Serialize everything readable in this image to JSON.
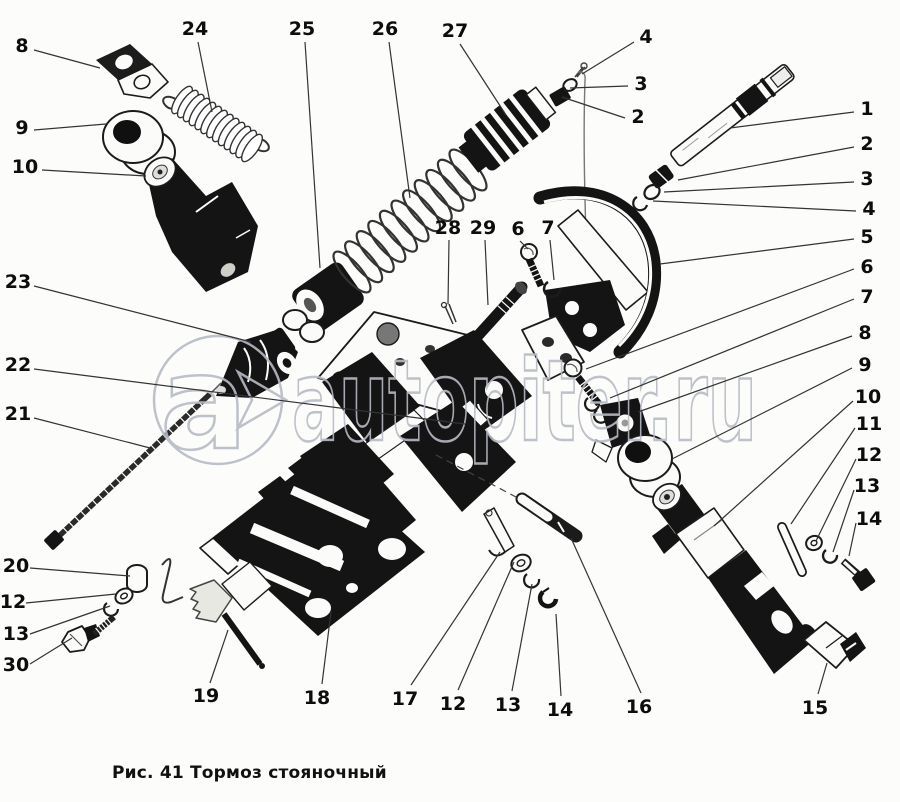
{
  "figure": {
    "caption": "Рис. 41 Тормоз стояночный",
    "watermark": {
      "logo": "a",
      "text": "autopiter.ru"
    },
    "callouts": [
      {
        "n": "8",
        "tx": 22,
        "ty": 52,
        "lx": 34,
        "ly": 50,
        "px": 100,
        "py": 68
      },
      {
        "n": "9",
        "tx": 22,
        "ty": 134,
        "lx": 34,
        "ly": 130,
        "px": 106,
        "py": 124
      },
      {
        "n": "10",
        "tx": 25,
        "ty": 173,
        "lx": 42,
        "ly": 170,
        "px": 146,
        "py": 176
      },
      {
        "n": "23",
        "tx": 18,
        "ty": 288,
        "lx": 34,
        "ly": 286,
        "px": 251,
        "py": 342
      },
      {
        "n": "22",
        "tx": 18,
        "ty": 371,
        "lx": 34,
        "ly": 369,
        "px": 465,
        "py": 424
      },
      {
        "n": "21",
        "tx": 18,
        "ty": 420,
        "lx": 34,
        "ly": 418,
        "px": 150,
        "py": 448
      },
      {
        "n": "20",
        "tx": 16,
        "ty": 572,
        "lx": 30,
        "ly": 568,
        "px": 130,
        "py": 576
      },
      {
        "n": "12",
        "tx": 13,
        "ty": 608,
        "lx": 26,
        "ly": 603,
        "px": 116,
        "py": 594
      },
      {
        "n": "13",
        "tx": 16,
        "ty": 640,
        "lx": 30,
        "ly": 634,
        "px": 110,
        "py": 606
      },
      {
        "n": "30",
        "tx": 16,
        "ty": 671,
        "lx": 30,
        "ly": 664,
        "px": 72,
        "py": 638
      },
      {
        "n": "24",
        "tx": 195,
        "ty": 35,
        "lx": 198,
        "ly": 42,
        "px": 212,
        "py": 112
      },
      {
        "n": "25",
        "tx": 302,
        "ty": 35,
        "lx": 305,
        "ly": 42,
        "px": 320,
        "py": 268
      },
      {
        "n": "26",
        "tx": 385,
        "ty": 35,
        "lx": 389,
        "ly": 42,
        "px": 410,
        "py": 198
      },
      {
        "n": "27",
        "tx": 455,
        "ty": 37,
        "lx": 460,
        "ly": 44,
        "px": 506,
        "py": 115
      },
      {
        "n": "4",
        "tx": 646,
        "ty": 43,
        "lx": 634,
        "ly": 42,
        "px": 582,
        "py": 74
      },
      {
        "n": "3",
        "tx": 641,
        "ty": 90,
        "lx": 628,
        "ly": 86,
        "px": 570,
        "py": 88
      },
      {
        "n": "2",
        "tx": 638,
        "ty": 123,
        "lx": 625,
        "ly": 118,
        "px": 562,
        "py": 97
      },
      {
        "n": "28",
        "tx": 448,
        "ty": 234,
        "lx": 449,
        "ly": 240,
        "px": 448,
        "py": 304
      },
      {
        "n": "29",
        "tx": 483,
        "ty": 234,
        "lx": 485,
        "ly": 240,
        "px": 488,
        "py": 305
      },
      {
        "n": "6",
        "tx": 518,
        "ty": 235,
        "lx": 520,
        "ly": 241,
        "px": 528,
        "py": 249
      },
      {
        "n": "7",
        "tx": 548,
        "ty": 234,
        "lx": 550,
        "ly": 240,
        "px": 554,
        "py": 280
      },
      {
        "n": "1",
        "tx": 867,
        "ty": 115,
        "lx": 854,
        "ly": 112,
        "px": 730,
        "py": 128
      },
      {
        "n": "2",
        "tx": 867,
        "ty": 150,
        "lx": 854,
        "ly": 147,
        "px": 678,
        "py": 180
      },
      {
        "n": "3",
        "tx": 867,
        "ty": 185,
        "lx": 854,
        "ly": 182,
        "px": 664,
        "py": 192
      },
      {
        "n": "4",
        "tx": 869,
        "ty": 215,
        "lx": 856,
        "ly": 211,
        "px": 653,
        "py": 201
      },
      {
        "n": "5",
        "tx": 867,
        "ty": 243,
        "lx": 854,
        "ly": 239,
        "px": 660,
        "py": 264
      },
      {
        "n": "6",
        "tx": 867,
        "ty": 273,
        "lx": 854,
        "ly": 269,
        "px": 586,
        "py": 369
      },
      {
        "n": "7",
        "tx": 867,
        "ty": 303,
        "lx": 854,
        "ly": 299,
        "px": 610,
        "py": 398
      },
      {
        "n": "8",
        "tx": 865,
        "ty": 339,
        "lx": 852,
        "ly": 336,
        "px": 638,
        "py": 412
      },
      {
        "n": "9",
        "tx": 865,
        "ty": 371,
        "lx": 852,
        "ly": 368,
        "px": 672,
        "py": 459
      },
      {
        "n": "10",
        "tx": 868,
        "ty": 403,
        "lx": 853,
        "ly": 401,
        "px": 714,
        "py": 526
      },
      {
        "n": "11",
        "tx": 869,
        "ty": 430,
        "lx": 855,
        "ly": 428,
        "px": 791,
        "py": 524
      },
      {
        "n": "12",
        "tx": 869,
        "ty": 461,
        "lx": 856,
        "ly": 459,
        "px": 816,
        "py": 541
      },
      {
        "n": "13",
        "tx": 867,
        "ty": 492,
        "lx": 854,
        "ly": 490,
        "px": 833,
        "py": 552
      },
      {
        "n": "14",
        "tx": 869,
        "ty": 525,
        "lx": 856,
        "ly": 523,
        "px": 849,
        "py": 556
      },
      {
        "n": "19",
        "tx": 206,
        "ty": 702,
        "lx": 210,
        "ly": 683,
        "px": 228,
        "py": 630
      },
      {
        "n": "18",
        "tx": 317,
        "ty": 704,
        "lx": 322,
        "ly": 684,
        "px": 331,
        "py": 612
      },
      {
        "n": "17",
        "tx": 405,
        "ty": 705,
        "lx": 411,
        "ly": 685,
        "px": 500,
        "py": 552
      },
      {
        "n": "12",
        "tx": 453,
        "ty": 710,
        "lx": 458,
        "ly": 690,
        "px": 514,
        "py": 562
      },
      {
        "n": "13",
        "tx": 508,
        "ty": 711,
        "lx": 512,
        "ly": 691,
        "px": 532,
        "py": 584
      },
      {
        "n": "14",
        "tx": 560,
        "ty": 716,
        "lx": 561,
        "ly": 696,
        "px": 556,
        "py": 614
      },
      {
        "n": "16",
        "tx": 639,
        "ty": 713,
        "lx": 641,
        "ly": 693,
        "px": 571,
        "py": 538
      },
      {
        "n": "15",
        "tx": 815,
        "ty": 714,
        "lx": 818,
        "ly": 694,
        "px": 827,
        "py": 663
      }
    ]
  }
}
